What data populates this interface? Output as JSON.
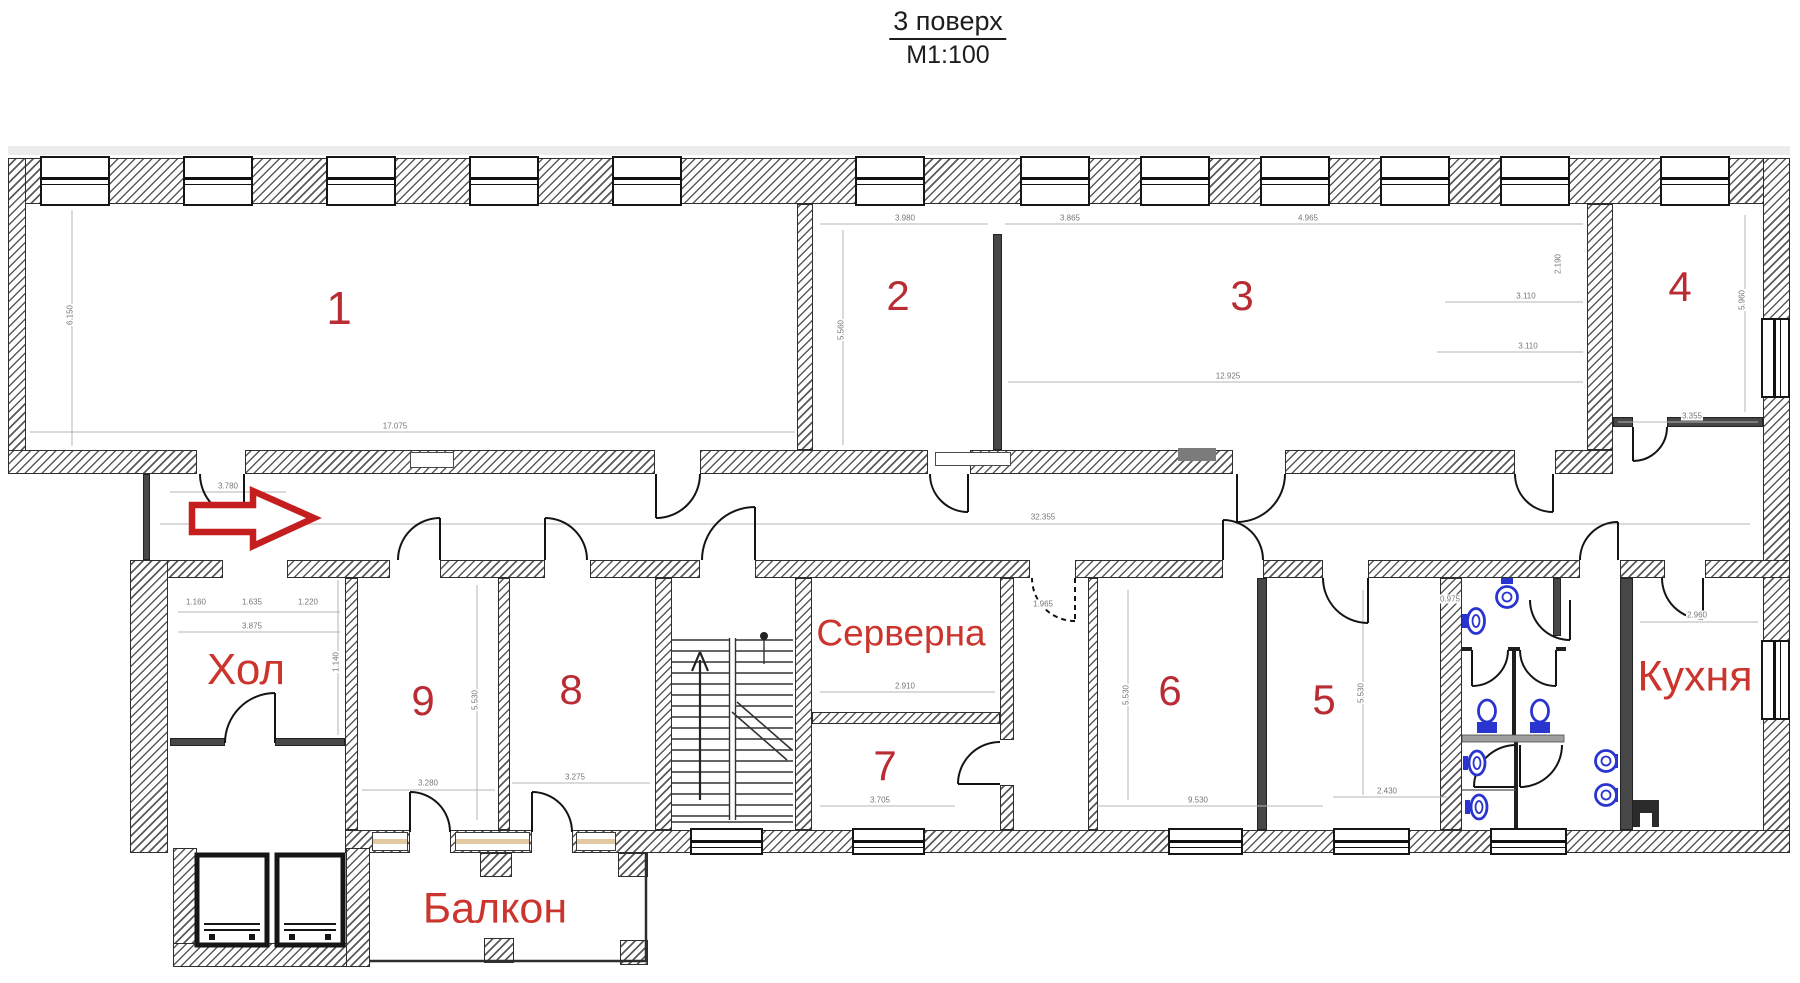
{
  "title": {
    "text": "3 поверх",
    "scale": "М1:100"
  },
  "rooms": {
    "r1": {
      "label": "1"
    },
    "r2": {
      "label": "2"
    },
    "r3": {
      "label": "3"
    },
    "r4": {
      "label": "4"
    },
    "r5": {
      "label": "5"
    },
    "r6": {
      "label": "6"
    },
    "r7": {
      "label": "7"
    },
    "r8": {
      "label": "8"
    },
    "r9": {
      "label": "9"
    },
    "hall": {
      "label": "Хол"
    },
    "server": {
      "label": "Серверна"
    },
    "kitchen": {
      "label": "Кухня"
    },
    "balcony": {
      "label": "Балкон"
    }
  },
  "colors": {
    "room_number_red": "#b92c33",
    "room_name_red": "#cb352d",
    "fixture_blue": "#2a35cf",
    "entrance_arrow_red": "#c41e1e",
    "wall_dark": "#2e2e2e",
    "dimension_gray": "#777777"
  },
  "dimensions": [
    {
      "text": "17.075",
      "x": 395,
      "y": 426,
      "rot": 0
    },
    {
      "text": "6.150",
      "x": 70,
      "y": 315,
      "rot": 90
    },
    {
      "text": "3.980",
      "x": 905,
      "y": 218,
      "rot": 0
    },
    {
      "text": "5.560",
      "x": 841,
      "y": 330,
      "rot": 90
    },
    {
      "text": "3.865",
      "x": 1070,
      "y": 218,
      "rot": 0
    },
    {
      "text": "4.965",
      "x": 1308,
      "y": 218,
      "rot": 0
    },
    {
      "text": "3.110",
      "x": 1526,
      "y": 296,
      "rot": 0
    },
    {
      "text": "3.110",
      "x": 1528,
      "y": 346,
      "rot": 0
    },
    {
      "text": "12.925",
      "x": 1228,
      "y": 376,
      "rot": 0
    },
    {
      "text": "2.190",
      "x": 1558,
      "y": 264,
      "rot": 90
    },
    {
      "text": "5.960",
      "x": 1742,
      "y": 300,
      "rot": 90
    },
    {
      "text": "3.355",
      "x": 1692,
      "y": 416,
      "rot": 0
    },
    {
      "text": "3.780",
      "x": 228,
      "y": 486,
      "rot": 0
    },
    {
      "text": "32.355",
      "x": 1043,
      "y": 517,
      "rot": 0
    },
    {
      "text": "1.160",
      "x": 196,
      "y": 602,
      "rot": 0
    },
    {
      "text": "1.635",
      "x": 252,
      "y": 602,
      "rot": 0
    },
    {
      "text": "1.220",
      "x": 308,
      "y": 602,
      "rot": 0
    },
    {
      "text": "3.875",
      "x": 252,
      "y": 626,
      "rot": 0
    },
    {
      "text": "1.140",
      "x": 336,
      "y": 662,
      "rot": 90
    },
    {
      "text": "3.280",
      "x": 428,
      "y": 783,
      "rot": 0
    },
    {
      "text": "3.275",
      "x": 575,
      "y": 777,
      "rot": 0
    },
    {
      "text": "5.530",
      "x": 475,
      "y": 700,
      "rot": 90
    },
    {
      "text": "2.910",
      "x": 905,
      "y": 686,
      "rot": 0
    },
    {
      "text": "3.705",
      "x": 880,
      "y": 800,
      "rot": 0
    },
    {
      "text": "1.965",
      "x": 1043,
      "y": 604,
      "rot": 0
    },
    {
      "text": "5.530",
      "x": 1126,
      "y": 695,
      "rot": 90
    },
    {
      "text": "9.530",
      "x": 1198,
      "y": 800,
      "rot": 0
    },
    {
      "text": "5.530",
      "x": 1361,
      "y": 693,
      "rot": 90
    },
    {
      "text": "2.430",
      "x": 1387,
      "y": 791,
      "rot": 0
    },
    {
      "text": "2.960",
      "x": 1697,
      "y": 615,
      "rot": 0
    },
    {
      "text": "0.975",
      "x": 1450,
      "y": 599,
      "rot": 0
    }
  ]
}
